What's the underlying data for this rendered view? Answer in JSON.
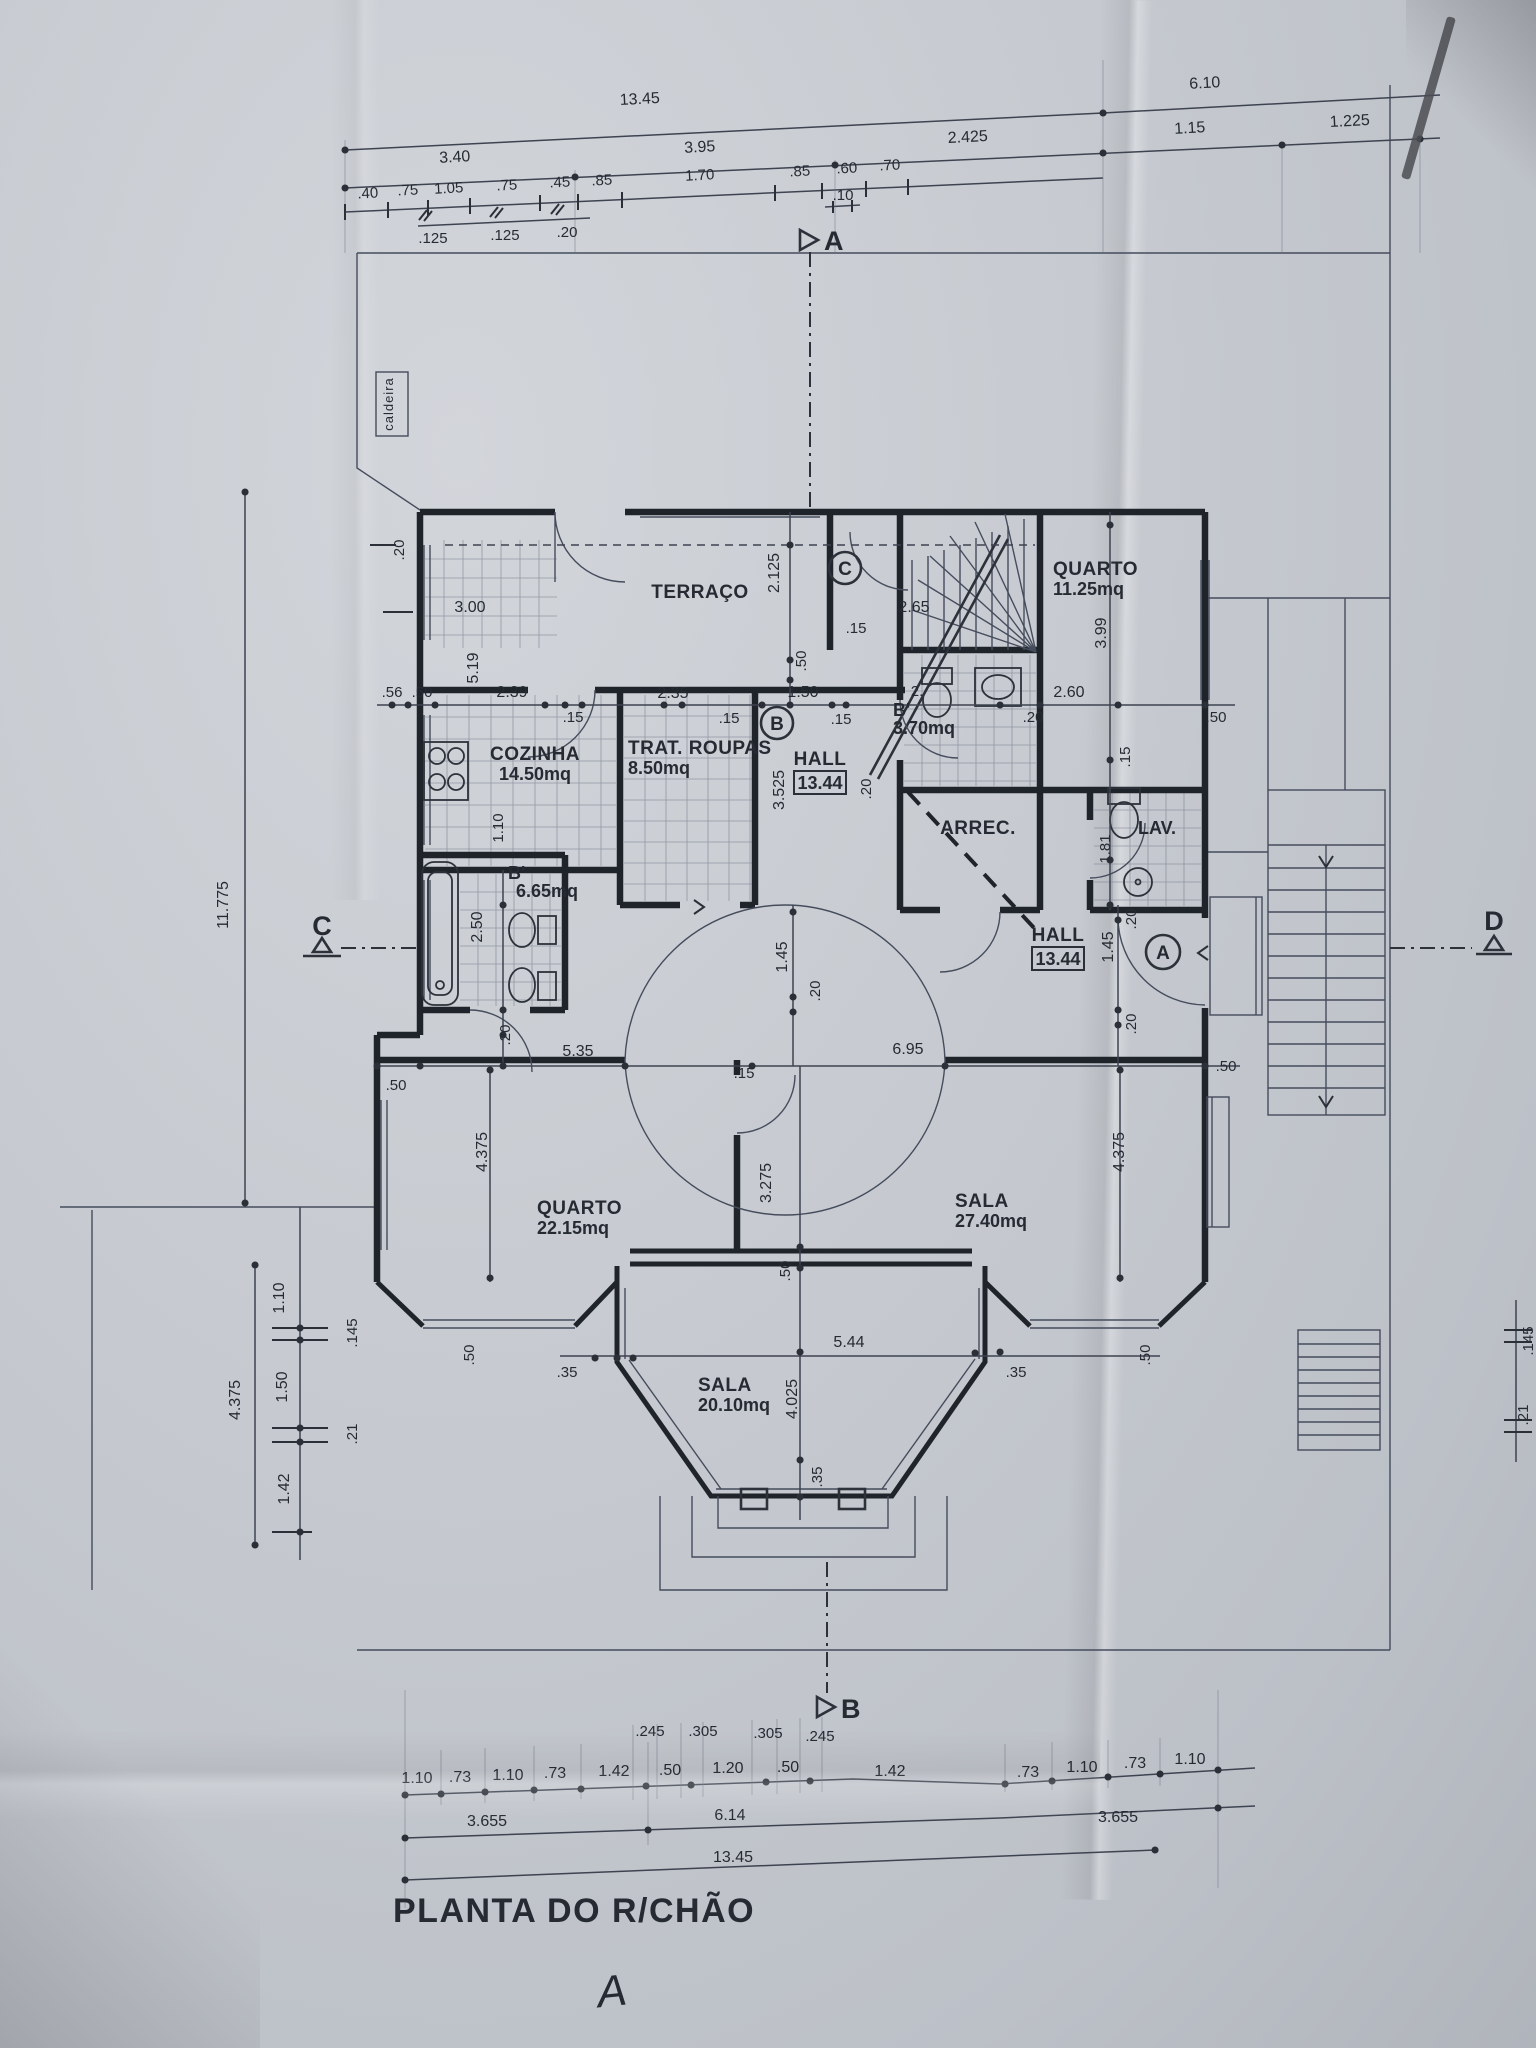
{
  "title": {
    "text": "PLANTA DO R/CHÃO",
    "note": "A"
  },
  "rooms": {
    "caldeira": "caldeira",
    "terraco": "TERRAÇO",
    "q1n": "QUARTO",
    "q1a": "11.25mq",
    "cozn": "COZINHA",
    "coza": "14.50mq",
    "trn": "TRAT.  ROUPAS",
    "tra": "8.50mq",
    "h1n": "HALL",
    "h1a": "13.44",
    "b1n": "B'",
    "b1a": "3.70mq",
    "arrec": "ARREC.",
    "lav": "LAV.",
    "b2n": "B'",
    "b2a": "6.65mq",
    "h2n": "HALL",
    "h2a": "13.44",
    "q2n": "QUARTO",
    "q2a": "22.15mq",
    "s1n": "SALA",
    "s1a": "27.40mq",
    "s2n": "SALA",
    "s2a": "20.10mq"
  },
  "sec": {
    "a": "A",
    "b": "B",
    "c": "C",
    "d": "D",
    "ca": "A",
    "cb": "B",
    "cc": "C"
  },
  "d": {
    "top1": [
      "13.45",
      "6.10"
    ],
    "top2": [
      "3.40",
      "3.95",
      "2.425",
      "1.15",
      "1.225"
    ],
    "top3": [
      ".40",
      ".75",
      "1.05",
      ".75",
      ".45",
      ".85",
      "1.70",
      ".85",
      ".60",
      ".70"
    ],
    "top3b": ".10",
    "top4": [
      ".125",
      ".125",
      ".20"
    ],
    "vleft": "11.775",
    "lbot": [
      "1.10",
      ".145",
      "1.50",
      ".21",
      "1.42",
      "4.375"
    ],
    "rbot": [
      ".145",
      ".21"
    ],
    "bot1": [
      ".245",
      ".305",
      ".305",
      ".245"
    ],
    "bot2": [
      "1.10",
      ".73",
      "1.10",
      ".73",
      "1.42",
      ".50",
      "1.20",
      ".50",
      "1.42",
      ".73",
      "1.10",
      ".73",
      "1.10"
    ],
    "bot3": [
      "3.655",
      "6.14",
      "3.655"
    ],
    "bot4": "13.45",
    "z1": [
      "3.00",
      ".20",
      "5.19",
      ".56",
      ".50",
      "2.39",
      ".15",
      "2.35",
      ".15",
      "1.50",
      ".15",
      "3.525",
      "1.10"
    ],
    "z2": [
      "2.125",
      "2.65",
      ".15",
      ".50",
      "3.99",
      "2.60",
      ".20",
      ".50",
      ".15",
      "2.",
      "1.81"
    ],
    "z3": [
      "1.45",
      ".20",
      "1.45",
      ".20",
      ".20",
      "5.35",
      ".50",
      ".15",
      "6.95",
      ".50",
      "2.50",
      ".20",
      ".20"
    ],
    "z4": [
      "4.375",
      "3.275",
      ".50",
      "4.375",
      ".50",
      ".50",
      ".35",
      ".35",
      "5.44",
      "4.025",
      ".35"
    ]
  }
}
